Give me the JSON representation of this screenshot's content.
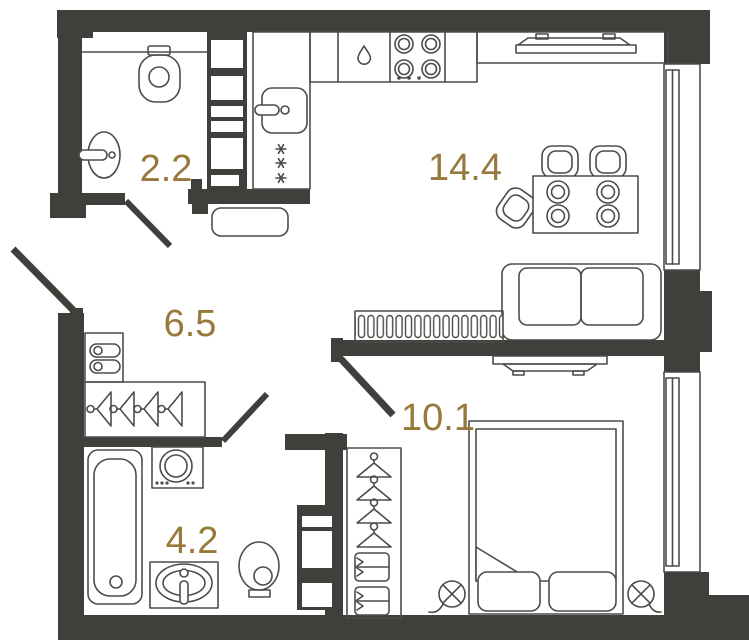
{
  "plan": {
    "title": "one-bedroom apartment floor plan",
    "rooms": [
      {
        "name": "wc",
        "area": "2.2",
        "fixtures": [
          "toilet",
          "washbasin"
        ]
      },
      {
        "name": "kitchen-living-room",
        "area": "14.4",
        "fixtures": [
          "kitchen-sink",
          "fridge-freezer",
          "dishwasher",
          "hob",
          "tv-with-console",
          "dining-table",
          "chairs",
          "sofa",
          "slatted-cabinet",
          "bench"
        ]
      },
      {
        "name": "hallway",
        "area": "6.5",
        "fixtures": [
          "shoe-cabinet",
          "coat-rack"
        ]
      },
      {
        "name": "bedroom",
        "area": "10.1",
        "fixtures": [
          "double-bed",
          "bedside-lamps",
          "wardrobe",
          "tv"
        ]
      },
      {
        "name": "bathroom",
        "area": "4.2",
        "fixtures": [
          "bathtub",
          "washing-machine",
          "washbasin",
          "toilet"
        ]
      }
    ],
    "colors": {
      "wall": "#3F3F3B",
      "line": "#4C4C48",
      "label": "#97793C",
      "bg": "#FFFFFF"
    }
  }
}
